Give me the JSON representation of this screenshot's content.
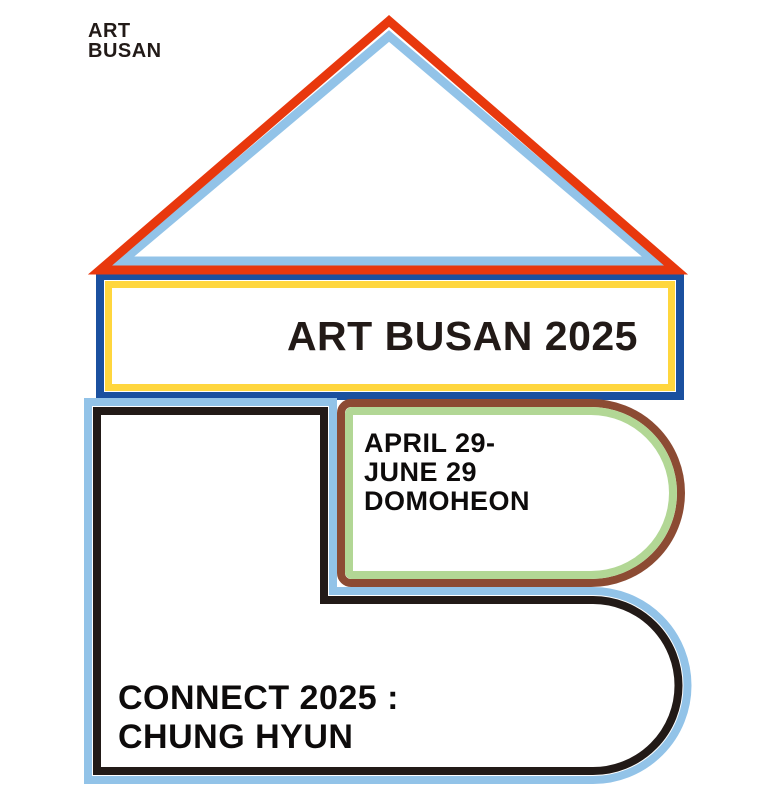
{
  "colors": {
    "red": "#e8380d",
    "lightblue": "#92c3e8",
    "darkblue": "#1a509f",
    "yellow": "#ffd63e",
    "brown": "#8c4b33",
    "green": "#b2d795",
    "ink": "#221a17",
    "black": "#0d0b0b"
  },
  "logo": {
    "line1": "ART",
    "line2": "BUSAN"
  },
  "banner": {
    "title": "ART BUSAN 2025"
  },
  "event": {
    "dates_line1": "APRIL 29-",
    "dates_line2": "JUNE 29",
    "venue": "DOMOHEON"
  },
  "exhibition": {
    "line1": "CONNECT 2025 :",
    "line2": "CHUNG HYUN"
  }
}
